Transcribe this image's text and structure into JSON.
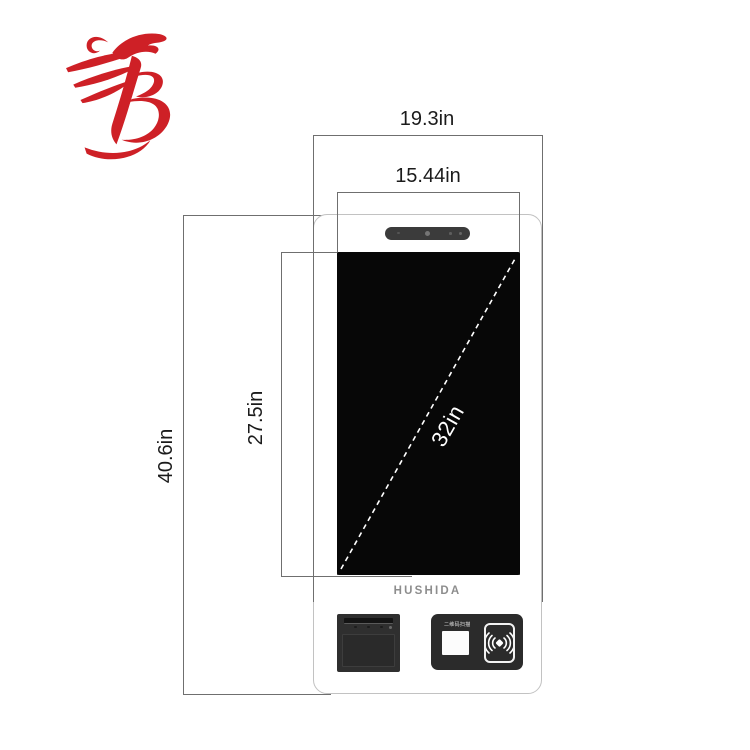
{
  "annotations": {
    "outer_width": "19.3in",
    "panel_width": "15.44in",
    "panel_height": "27.5in",
    "total_height": "40.6in",
    "screen_diagonal": "32in"
  },
  "kiosk": {
    "brand": "HUSHIDA",
    "qr_scanner_label": "二维码扫描"
  },
  "colors": {
    "dimension_line": "#6f6f6f",
    "kiosk_outline": "#c2c2c2",
    "screen_black": "#070707",
    "module_dark": "#2b2b2b",
    "brand_text": "#8d8d8d",
    "logo_red": "#ce2026",
    "diagonal_dash": "#ffffff"
  }
}
